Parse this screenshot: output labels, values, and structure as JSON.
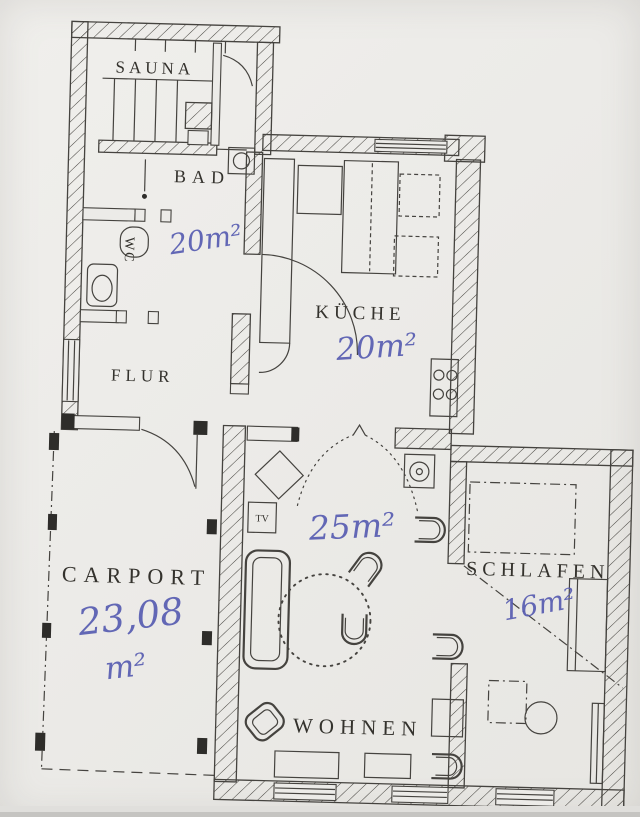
{
  "document": {
    "type": "scanned architectural floor plan",
    "language": "de"
  },
  "style": {
    "paper_color": "#ecebe8",
    "line_color": "#45433f",
    "annotation_color": "#575cb1"
  },
  "rooms": {
    "sauna": {
      "label": "SAUNA"
    },
    "bad": {
      "label": "BAD",
      "area_annotation": "20m²"
    },
    "wc": {
      "label": "WC"
    },
    "flur": {
      "label": "FLUR"
    },
    "kueche": {
      "label": "KÜCHE",
      "area_annotation": "20m²"
    },
    "wohnen": {
      "label": "WOHNEN",
      "area_annotation": "25m²"
    },
    "schlafen": {
      "label": "SCHLAFEN",
      "area_annotation": "16m²"
    },
    "carport": {
      "label": "CARPORT",
      "area_annotation_value": "23,08",
      "area_annotation_unit": "m²"
    }
  },
  "furniture": {
    "tv_label": "TV"
  }
}
